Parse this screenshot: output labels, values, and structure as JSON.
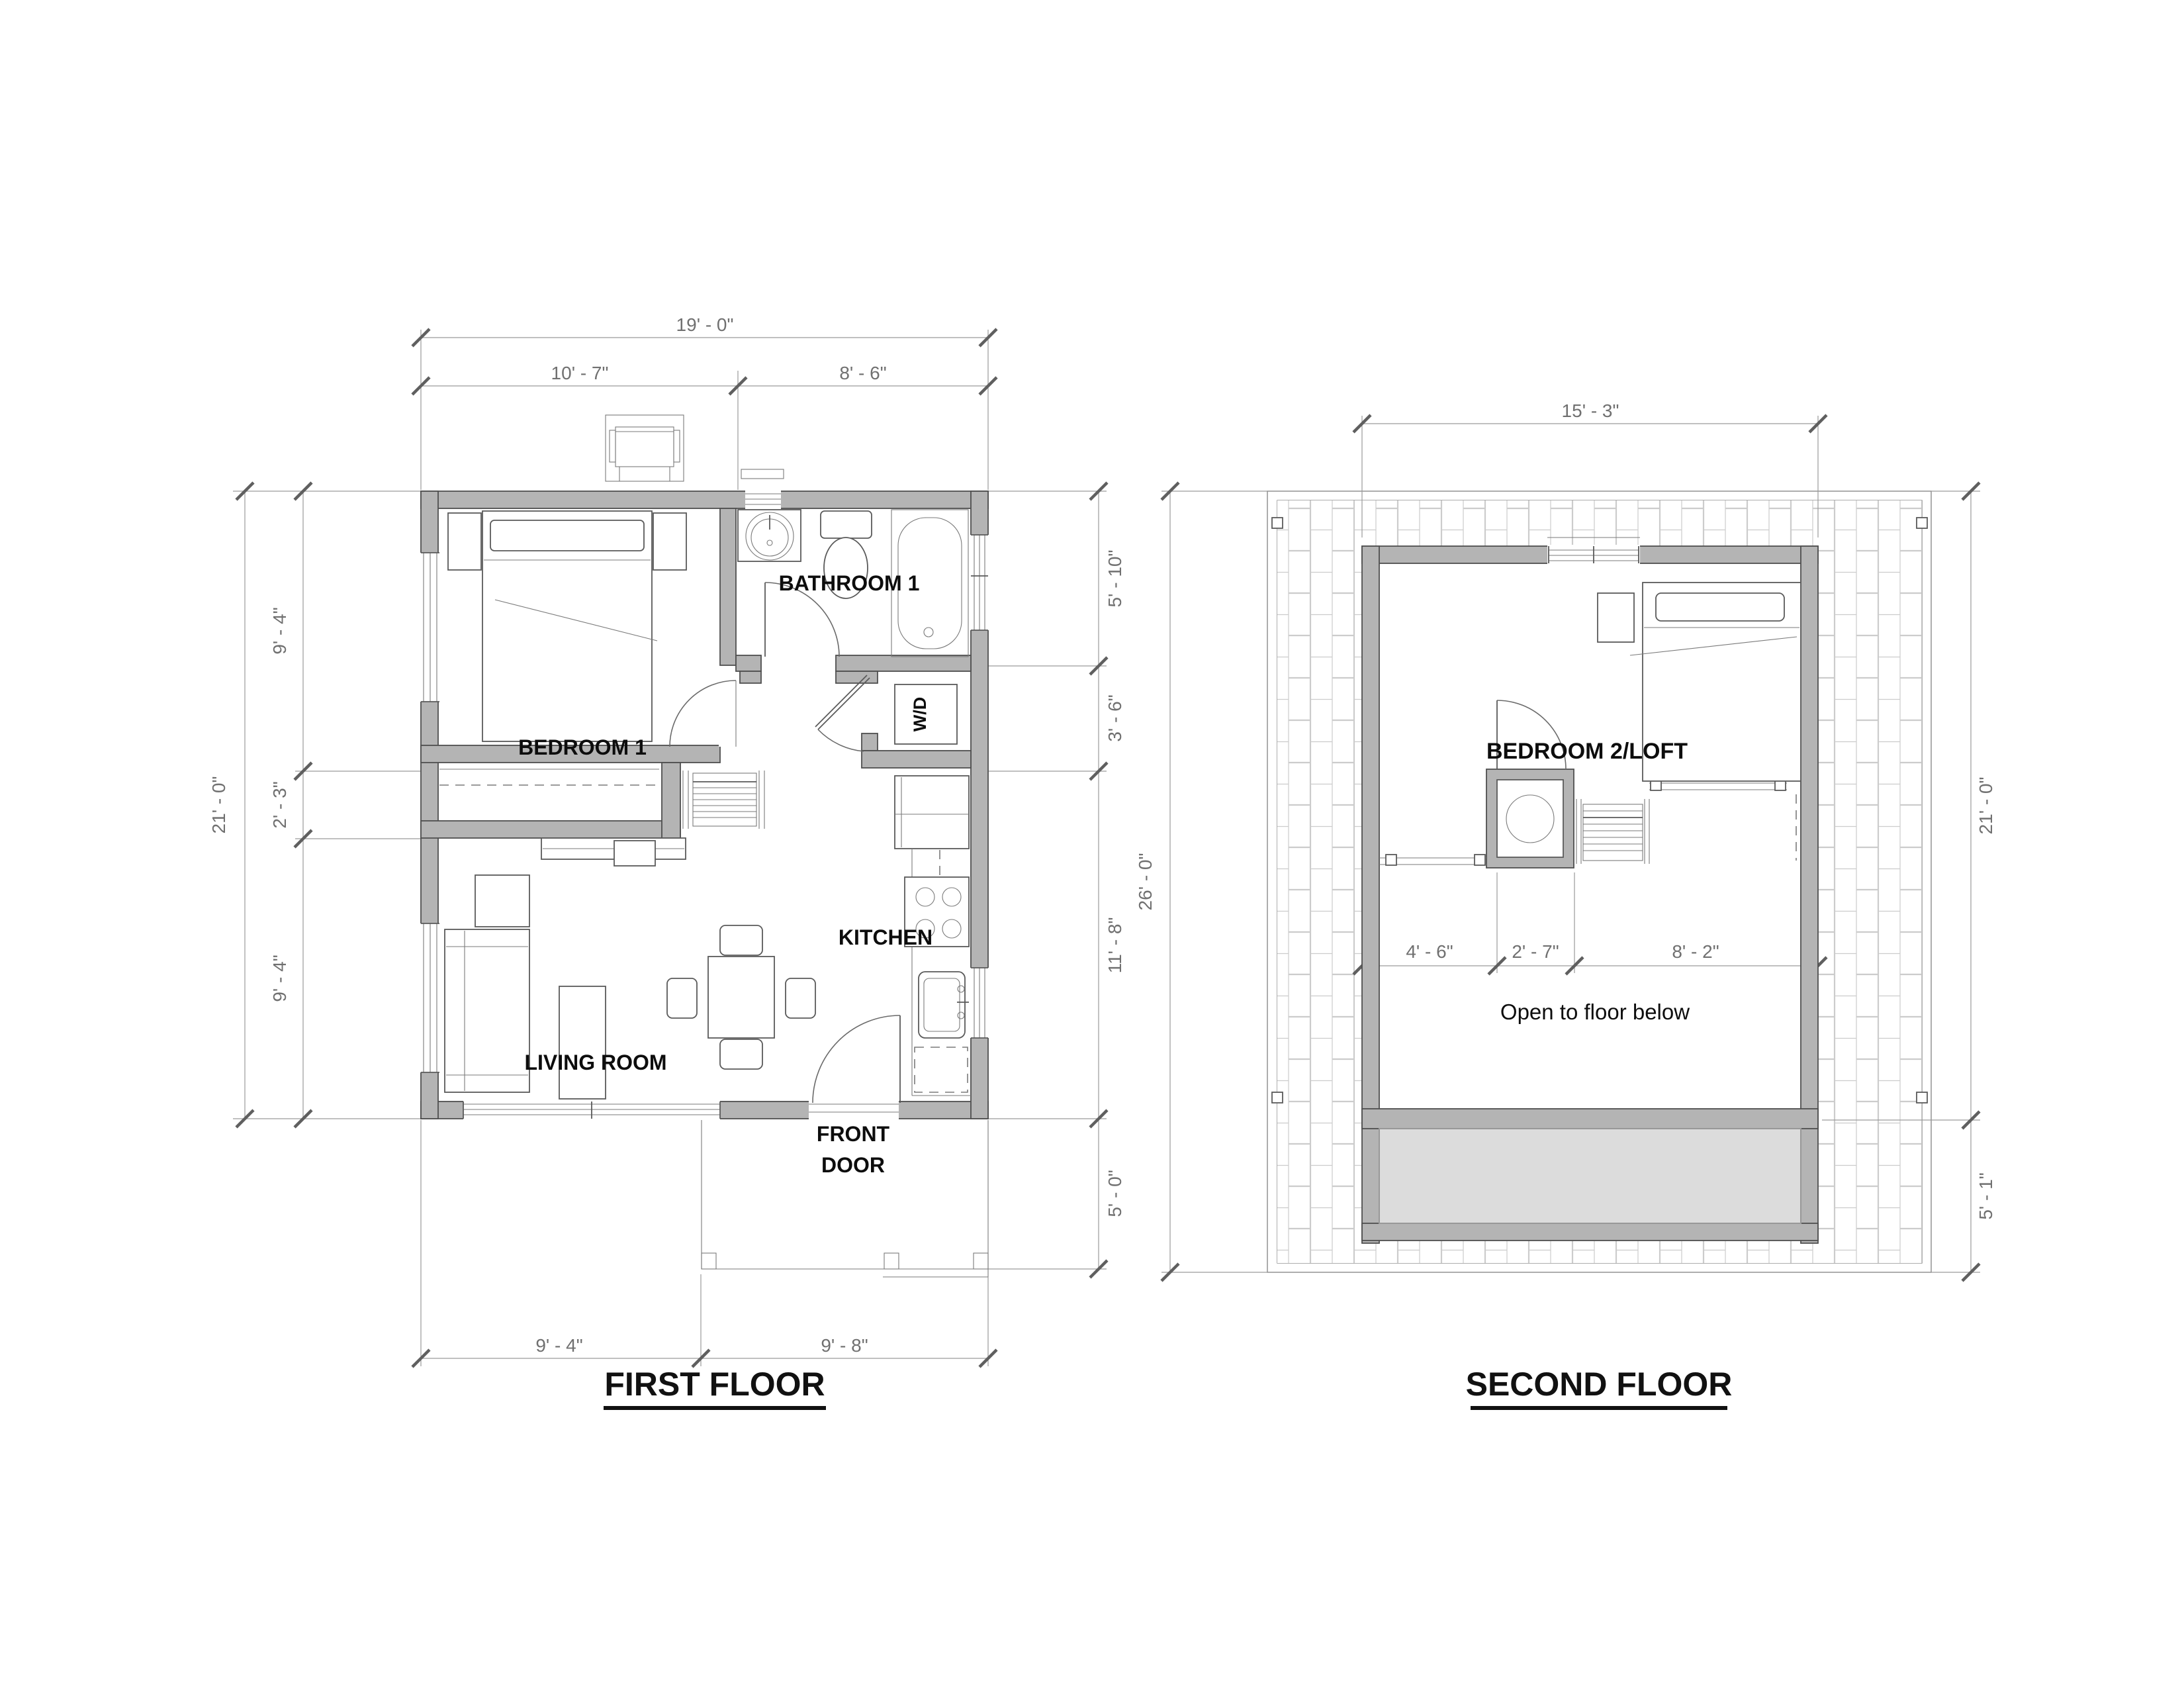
{
  "document": {
    "titles": {
      "first": "FIRST FLOOR",
      "second": "SECOND FLOOR"
    }
  },
  "first_floor": {
    "labels": {
      "bedroom1": "BEDROOM 1",
      "bathroom1": "BATHROOM 1",
      "kitchen": "KITCHEN",
      "living_room": "LIVING ROOM",
      "front_door_line1": "FRONT",
      "front_door_line2": "DOOR",
      "washer_dryer": "W/D"
    },
    "dimensions": {
      "overall_width": "19' - 0\"",
      "top_left": "10' - 7\"",
      "top_right": "8' - 6\"",
      "overall_depth": "21' - 0\"",
      "left_upper": "9' - 4\"",
      "left_middle": "2' - 3\"",
      "left_lower": "9' - 4\"",
      "right_bath": "5' - 10\"",
      "right_utility": "3' - 6\"",
      "right_kitchen": "11' - 8\"",
      "right_porch": "5' - 0\"",
      "bottom_left": "9' - 4\"",
      "bottom_right": "9' - 8\""
    }
  },
  "second_floor": {
    "labels": {
      "bedroom2": "BEDROOM 2/LOFT",
      "open_below": "Open to floor below"
    },
    "dimensions": {
      "top_width": "15' - 3\"",
      "left_overall": "26' - 0\"",
      "right_upper": "21' - 0\"",
      "right_lower": "5' - 1\"",
      "mid_left": "4' - 6\"",
      "mid_center": "2' - 7\"",
      "mid_right": "8' - 2\""
    }
  },
  "colors": {
    "wall_fill": "#b4b4b4",
    "wall_edge": "#4f4f4f",
    "dimension_line": "#9a9a9a",
    "dimension_text": "#707070",
    "label_text": "#0d0d0d",
    "hatch_line": "#cccccc",
    "roof_deck_fill": "#dcdcdc"
  }
}
